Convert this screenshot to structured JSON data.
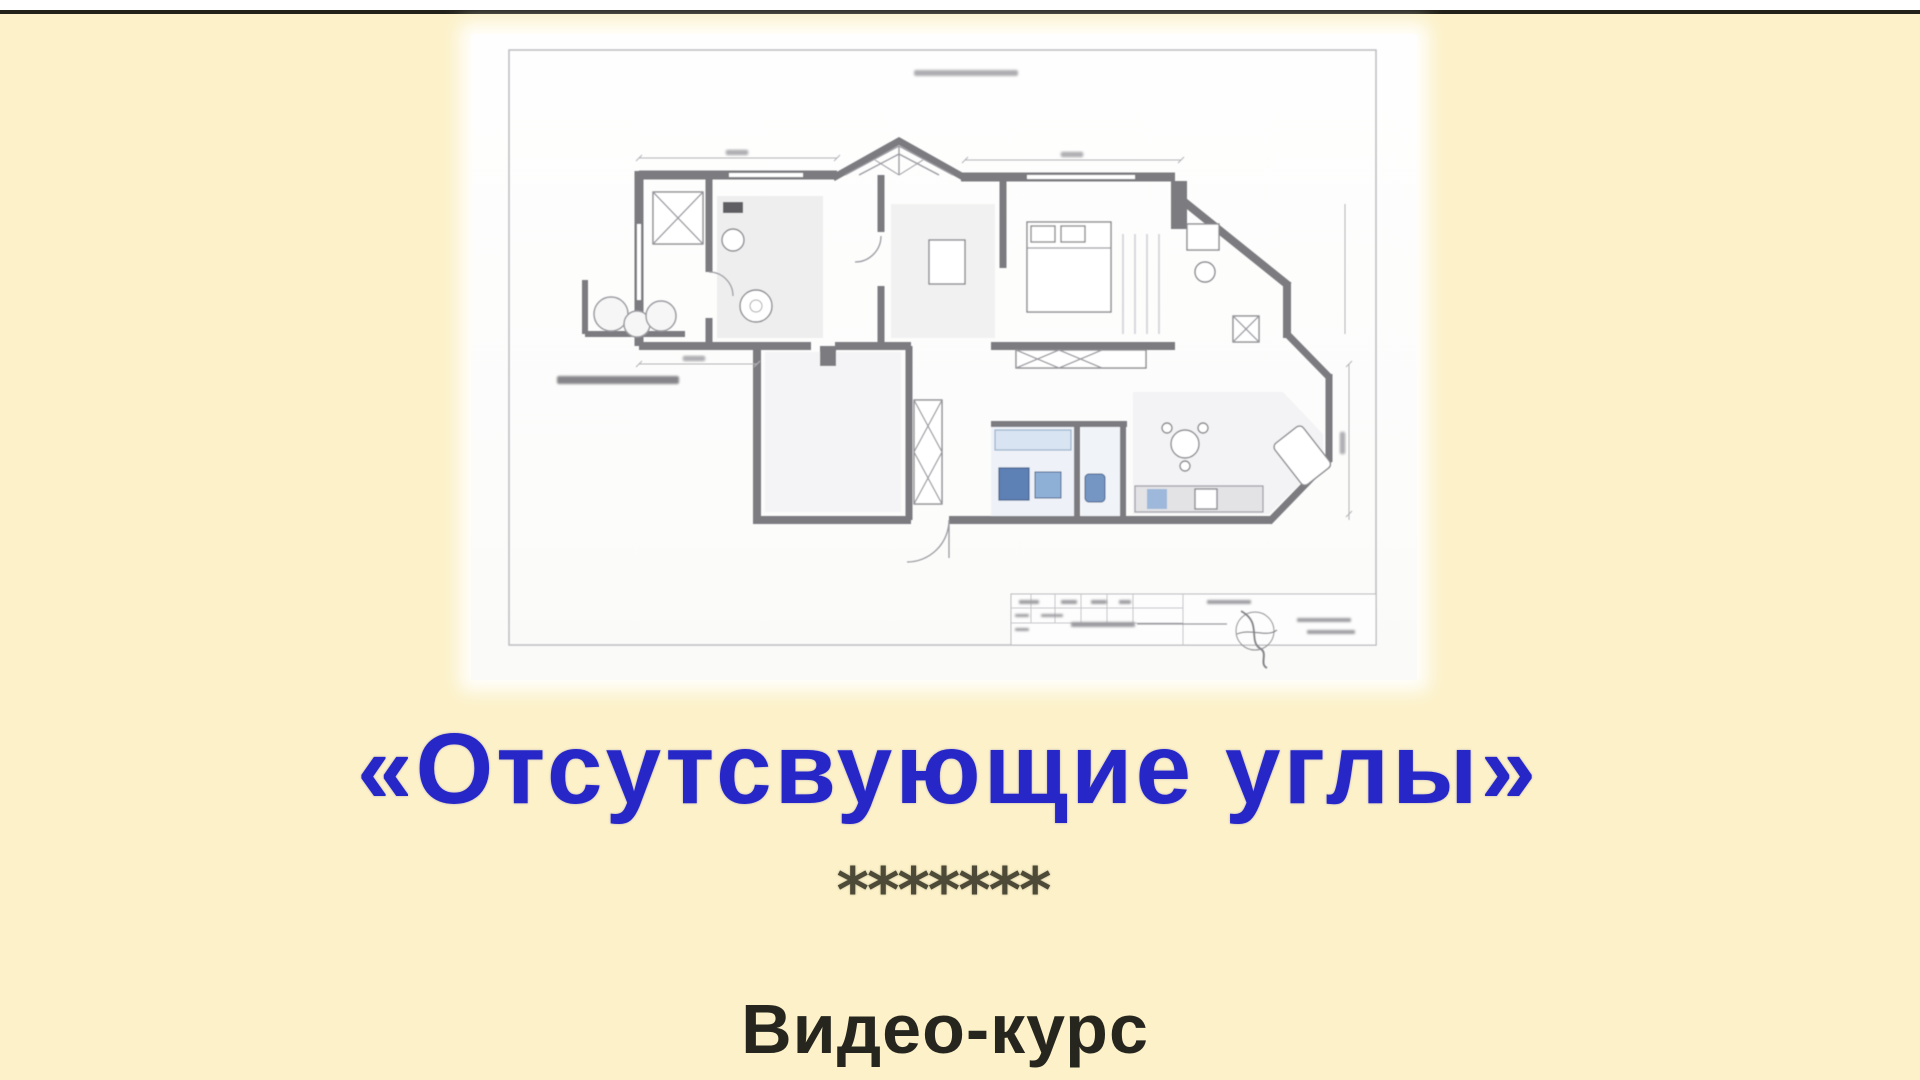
{
  "theme": {
    "page_bg": "#fcf1c8",
    "top_strip": "#ffffff",
    "top_rule": "#23221a",
    "title_color": "#2727c8",
    "separator_color": "#4e4a38",
    "subtitle_color": "#26261f",
    "sheet_bg": "#fdfdfc",
    "wall": "#7b7b80",
    "floor": "#e8e8ea",
    "frame": "#bdbdc2",
    "fixture": "#5d80b5"
  },
  "main": {
    "title": "«Отсутсвующие углы»",
    "separator": "*******",
    "subtitle": "Видео-курс"
  },
  "floor_plan": {
    "alt": "Blurred architectural furniture-layout floor plan of an apartment on a white drawing sheet with frame and title block"
  }
}
